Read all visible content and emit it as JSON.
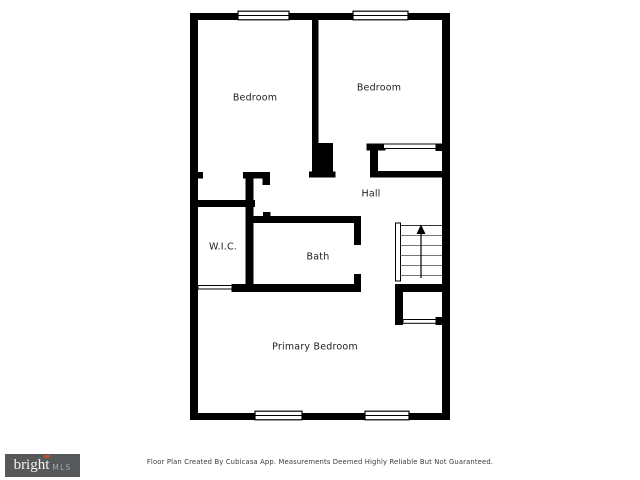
{
  "rooms": {
    "bedroom_left": "Bedroom",
    "bedroom_right": "Bedroom",
    "hall": "Hall",
    "wic": "W.I.C.",
    "bath": "Bath",
    "primary_bedroom": "Primary Bedroom"
  },
  "stairs": {
    "direction_icon": "up-arrow",
    "tread_count": 6
  },
  "windows": {
    "top_count": 2,
    "bottom_count": 2
  },
  "colors": {
    "wall": "#000000",
    "background": "#ffffff",
    "tread_gray": "#767676",
    "logo_bg": "#57585a",
    "logo_accent": "#c8502e"
  },
  "footer": {
    "disclaimer": "Floor Plan Created By Cubicasa App. Measurements Deemed Highly Reliable But Not Guaranteed.",
    "logo": {
      "brand": "bright",
      "suffix": "MLS"
    }
  }
}
